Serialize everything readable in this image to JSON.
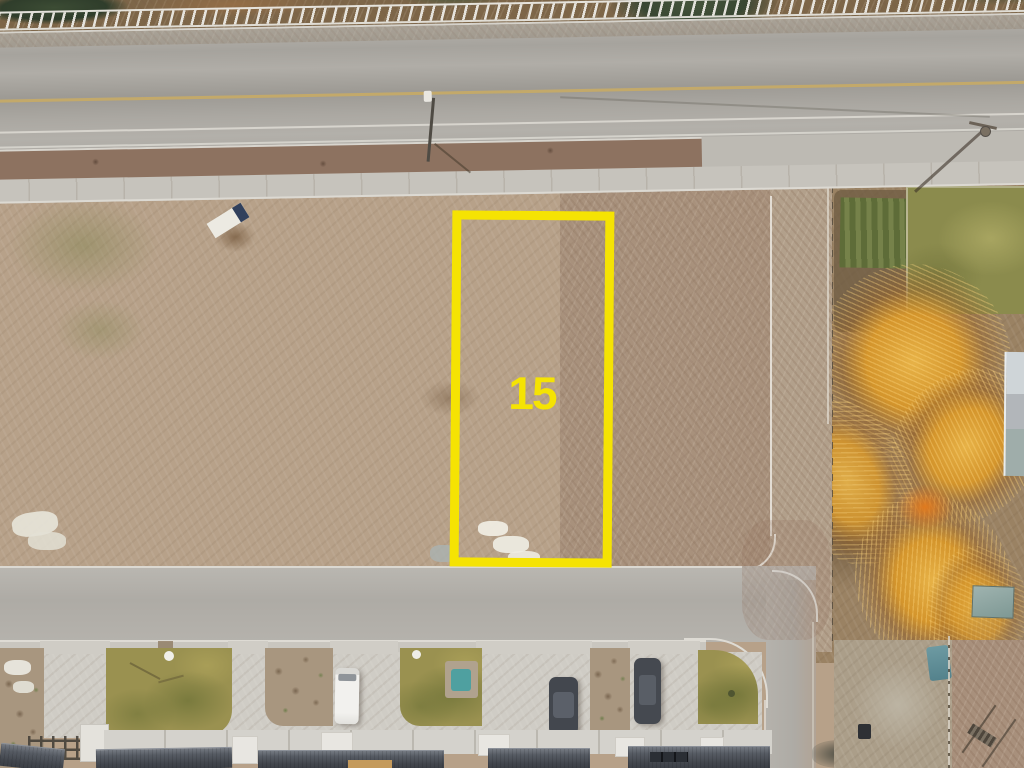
{
  "scene": {
    "type": "aerial-drone-photo",
    "description": "Overhead drone view of a vacant dirt lot for sale, outlined in yellow between a highway at top and a residential street with townhomes at bottom; autumn-orange trees and a grass field on the right.",
    "lot_marker": {
      "label": "15",
      "outline_color": "#F5E303",
      "label_color": "#F5E303"
    },
    "objects": [
      "highway",
      "white-rail-fence",
      "street-light",
      "utility-pole",
      "vacant-dirt-lot",
      "fallen-sign",
      "construction-debris",
      "gravel-driveway",
      "garden-plot",
      "grass-field",
      "autumn-trees",
      "residential-street",
      "sidewalk",
      "white-camper-van",
      "dark-sedan",
      "dark-suv",
      "townhouse-roofs",
      "lawns",
      "xeriscape-strips",
      "kiddie-pool",
      "pergola",
      "shed",
      "tarp",
      "trash-bin"
    ],
    "palette": {
      "marker_yellow": "#F5E303",
      "dirt_light": "#C9BBA3",
      "dirt_base": "#B7A189",
      "dirt_dark": "#97816A",
      "highway_asphalt": "#A8A59F",
      "street_asphalt": "#B2AFA9",
      "concrete": "#CFCCC5",
      "lane_yellow": "#C3A96A",
      "line_white": "#DBD8D1",
      "lawn_olive": "#9A9150",
      "grass_field": "#8B8B4D",
      "garden_green": "#66743C",
      "autumn_orange": "#D4952C",
      "tree_green": "#44533A",
      "roof_slate": "#4A4E55",
      "van_white": "#F0EFEC",
      "car_dark": "#43474E",
      "pool_teal": "#4FA0A0",
      "tarp_teal": "#5F8D96"
    }
  }
}
